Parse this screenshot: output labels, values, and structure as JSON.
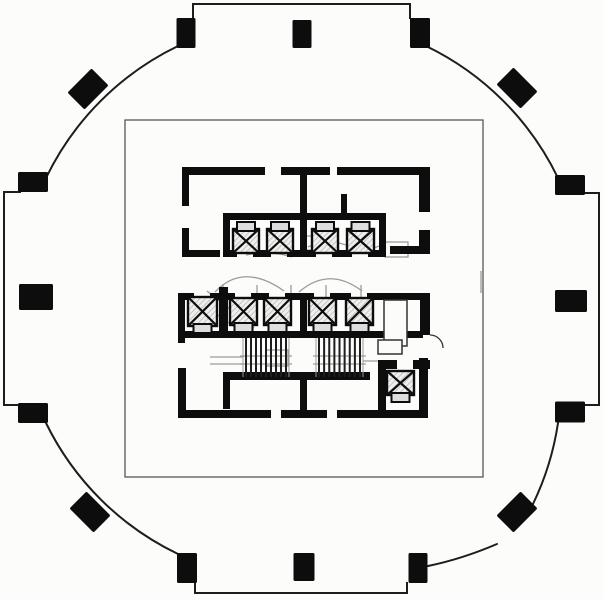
{
  "palette": {
    "paper": "#fcfcfa",
    "ink": "#0d0d0d",
    "line": "#1d1d1d",
    "boundary": "#4a4a4a",
    "thin": "#333333",
    "ghost": "#9b9b9b",
    "hatch": "#b9b9b9",
    "bar_fill": "#dedede"
  },
  "canvas": {
    "width": 604,
    "height": 600
  },
  "outer": {
    "face_lines": [
      {
        "x1": 193,
        "y1": 4,
        "x2": 410,
        "y2": 4
      },
      {
        "x1": 193,
        "y1": 4,
        "x2": 193,
        "y2": 18
      },
      {
        "x1": 410,
        "y1": 4,
        "x2": 410,
        "y2": 18
      },
      {
        "x1": 195,
        "y1": 593,
        "x2": 407,
        "y2": 593
      },
      {
        "x1": 195,
        "y1": 583,
        "x2": 195,
        "y2": 593
      },
      {
        "x1": 407,
        "y1": 583,
        "x2": 407,
        "y2": 593
      },
      {
        "x1": 4,
        "y1": 192,
        "x2": 4,
        "y2": 405
      },
      {
        "x1": 4,
        "y1": 192,
        "x2": 20,
        "y2": 192
      },
      {
        "x1": 4,
        "y1": 405,
        "x2": 20,
        "y2": 405
      },
      {
        "x1": 599,
        "y1": 193,
        "x2": 599,
        "y2": 405
      },
      {
        "x1": 585,
        "y1": 193,
        "x2": 599,
        "y2": 193
      },
      {
        "x1": 585,
        "y1": 405,
        "x2": 599,
        "y2": 405
      }
    ],
    "corner_arcs": [
      {
        "d": "M 178 46 A 283 283 0 0 0 46 178"
      },
      {
        "d": "M 426 46 A 283 283 0 0 1 558 178"
      },
      {
        "d": "M 558 423 A 283 283 0 0 1 533 504"
      },
      {
        "d": "M 428 566 Q 462 559 497 544"
      },
      {
        "d": "M 178 554 A 283 283 0 0 1 46 423"
      }
    ],
    "columns": [
      {
        "cx": 186,
        "cy": 33,
        "w": 19,
        "h": 30,
        "rot": 0
      },
      {
        "cx": 302,
        "cy": 34,
        "w": 19,
        "h": 28,
        "rot": 0
      },
      {
        "cx": 420,
        "cy": 33,
        "w": 20,
        "h": 30,
        "rot": 0
      },
      {
        "cx": 187,
        "cy": 568,
        "w": 20,
        "h": 30,
        "rot": 0
      },
      {
        "cx": 304,
        "cy": 567,
        "w": 21,
        "h": 28,
        "rot": 0
      },
      {
        "cx": 418,
        "cy": 568,
        "w": 19,
        "h": 30,
        "rot": 0
      },
      {
        "cx": 33,
        "cy": 182,
        "w": 30,
        "h": 20,
        "rot": 0
      },
      {
        "cx": 36,
        "cy": 297,
        "w": 34,
        "h": 26,
        "rot": 0
      },
      {
        "cx": 33,
        "cy": 413,
        "w": 30,
        "h": 20,
        "rot": 0
      },
      {
        "cx": 570,
        "cy": 185,
        "w": 30,
        "h": 20,
        "rot": 0
      },
      {
        "cx": 571,
        "cy": 301,
        "w": 32,
        "h": 22,
        "rot": 0
      },
      {
        "cx": 570,
        "cy": 412,
        "w": 30,
        "h": 21,
        "rot": 0
      },
      {
        "cx": 88,
        "cy": 89,
        "w": 34,
        "h": 24,
        "rot": -45
      },
      {
        "cx": 517,
        "cy": 88,
        "w": 34,
        "h": 24,
        "rot": 45
      },
      {
        "cx": 90,
        "cy": 512,
        "w": 34,
        "h": 24,
        "rot": 45
      },
      {
        "cx": 517,
        "cy": 512,
        "w": 34,
        "h": 24,
        "rot": -45
      }
    ]
  },
  "inner_boundary": {
    "x": 125,
    "y": 120,
    "w": 358,
    "h": 357
  },
  "core": {
    "walls": [
      {
        "x": 182,
        "y": 167,
        "w": 83,
        "h": 8
      },
      {
        "x": 281,
        "y": 167,
        "w": 49,
        "h": 8
      },
      {
        "x": 300,
        "y": 175,
        "w": 7,
        "h": 46
      },
      {
        "x": 337,
        "y": 167,
        "w": 93,
        "h": 8
      },
      {
        "x": 419,
        "y": 175,
        "w": 11,
        "h": 37
      },
      {
        "x": 419,
        "y": 230,
        "w": 11,
        "h": 23
      },
      {
        "x": 390,
        "y": 246,
        "w": 40,
        "h": 8
      },
      {
        "x": 182,
        "y": 175,
        "w": 7,
        "h": 31
      },
      {
        "x": 182,
        "y": 228,
        "w": 7,
        "h": 22
      },
      {
        "x": 182,
        "y": 250,
        "w": 38,
        "h": 7
      },
      {
        "x": 341,
        "y": 194,
        "w": 6,
        "h": 21
      },
      {
        "x": 223,
        "y": 213,
        "w": 163,
        "h": 7
      },
      {
        "x": 223,
        "y": 220,
        "w": 7,
        "h": 37
      },
      {
        "x": 379,
        "y": 220,
        "w": 7,
        "h": 37
      },
      {
        "x": 300,
        "y": 220,
        "w": 7,
        "h": 31
      },
      {
        "x": 223,
        "y": 250,
        "w": 14,
        "h": 7
      },
      {
        "x": 253,
        "y": 250,
        "w": 18,
        "h": 7
      },
      {
        "x": 287,
        "y": 250,
        "w": 29,
        "h": 7
      },
      {
        "x": 332,
        "y": 250,
        "w": 20,
        "h": 7
      },
      {
        "x": 368,
        "y": 250,
        "w": 18,
        "h": 7
      },
      {
        "x": 178,
        "y": 293,
        "w": 16,
        "h": 7
      },
      {
        "x": 210,
        "y": 293,
        "w": 25,
        "h": 7
      },
      {
        "x": 251,
        "y": 293,
        "w": 18,
        "h": 7
      },
      {
        "x": 285,
        "y": 293,
        "w": 29,
        "h": 7
      },
      {
        "x": 330,
        "y": 293,
        "w": 21,
        "h": 7
      },
      {
        "x": 367,
        "y": 293,
        "w": 63,
        "h": 7
      },
      {
        "x": 178,
        "y": 293,
        "w": 7,
        "h": 50
      },
      {
        "x": 219,
        "y": 287,
        "w": 9,
        "h": 50
      },
      {
        "x": 300,
        "y": 293,
        "w": 7,
        "h": 45
      },
      {
        "x": 420,
        "y": 293,
        "w": 10,
        "h": 42
      },
      {
        "x": 185,
        "y": 331,
        "w": 238,
        "h": 7
      },
      {
        "x": 178,
        "y": 368,
        "w": 8,
        "h": 50
      },
      {
        "x": 223,
        "y": 372,
        "w": 147,
        "h": 8
      },
      {
        "x": 223,
        "y": 380,
        "w": 7,
        "h": 29
      },
      {
        "x": 300,
        "y": 380,
        "w": 7,
        "h": 31
      },
      {
        "x": 178,
        "y": 410,
        "w": 93,
        "h": 8
      },
      {
        "x": 281,
        "y": 410,
        "w": 46,
        "h": 8
      },
      {
        "x": 337,
        "y": 410,
        "w": 90,
        "h": 8
      },
      {
        "x": 419,
        "y": 358,
        "w": 9,
        "h": 60
      },
      {
        "x": 378,
        "y": 360,
        "w": 19,
        "h": 9
      },
      {
        "x": 413,
        "y": 360,
        "w": 17,
        "h": 9
      },
      {
        "x": 378,
        "y": 369,
        "w": 8,
        "h": 49
      }
    ],
    "elevators": [
      {
        "x": 233,
        "y": 222,
        "w": 26,
        "h": 31,
        "cw": "top"
      },
      {
        "x": 267,
        "y": 222,
        "w": 26,
        "h": 31,
        "cw": "top"
      },
      {
        "x": 312,
        "y": 222,
        "w": 26,
        "h": 31,
        "cw": "top"
      },
      {
        "x": 347,
        "y": 222,
        "w": 27,
        "h": 31,
        "cw": "top"
      },
      {
        "x": 188,
        "y": 297,
        "w": 29,
        "h": 36,
        "cw": "bottom"
      },
      {
        "x": 230,
        "y": 298,
        "w": 27,
        "h": 34,
        "cw": "bottom"
      },
      {
        "x": 264,
        "y": 298,
        "w": 27,
        "h": 34,
        "cw": "bottom"
      },
      {
        "x": 309,
        "y": 298,
        "w": 27,
        "h": 34,
        "cw": "bottom"
      },
      {
        "x": 346,
        "y": 298,
        "w": 27,
        "h": 34,
        "cw": "bottom"
      },
      {
        "x": 387,
        "y": 371,
        "w": 27,
        "h": 31,
        "cw": "bottom"
      }
    ],
    "stairs": [
      {
        "x": 246,
        "y": 338,
        "w": 40,
        "h": 39,
        "treads": 9
      },
      {
        "x": 319,
        "y": 338,
        "w": 41,
        "h": 39,
        "treads": 9
      }
    ],
    "shafts": [
      {
        "x": 384,
        "y": 300,
        "w": 23,
        "h": 46
      },
      {
        "x": 378,
        "y": 340,
        "w": 24,
        "h": 14
      }
    ],
    "door_arcs": [
      {
        "d": "M 430 335 A 13 13 0 0 1 443 348"
      }
    ]
  },
  "ghosts": {
    "paths": [
      {
        "d": "M 215 292 Q 243 262 284 291"
      },
      {
        "d": "M 299 292 Q 329 266 362 291"
      },
      {
        "d": "M 193 297 L 240 331"
      },
      {
        "d": "M 207 291 L 254 328"
      },
      {
        "d": "M 308 247 Q 329 237 351 247 Q 367 253 386 243"
      },
      {
        "d": "M 246 255 Q 270 250 292 257"
      },
      {
        "d": "M 223 285 L 223 302"
      },
      {
        "d": "M 257 285 L 257 302"
      },
      {
        "d": "M 291 285 L 291 302"
      },
      {
        "d": "M 326 285 L 326 302"
      },
      {
        "d": "M 361 285 L 361 302"
      },
      {
        "d": "M 363 361 L 389 361"
      },
      {
        "d": "M 210 357 L 243 357"
      },
      {
        "d": "M 210 364 L 243 364"
      },
      {
        "d": "M 481 271 L 481 293"
      }
    ],
    "rects": [
      {
        "x": 385,
        "y": 242,
        "w": 23,
        "h": 15
      },
      {
        "x": 302,
        "y": 236,
        "w": 24,
        "h": 14
      },
      {
        "x": 266,
        "y": 350,
        "w": 22,
        "h": 16
      }
    ]
  }
}
